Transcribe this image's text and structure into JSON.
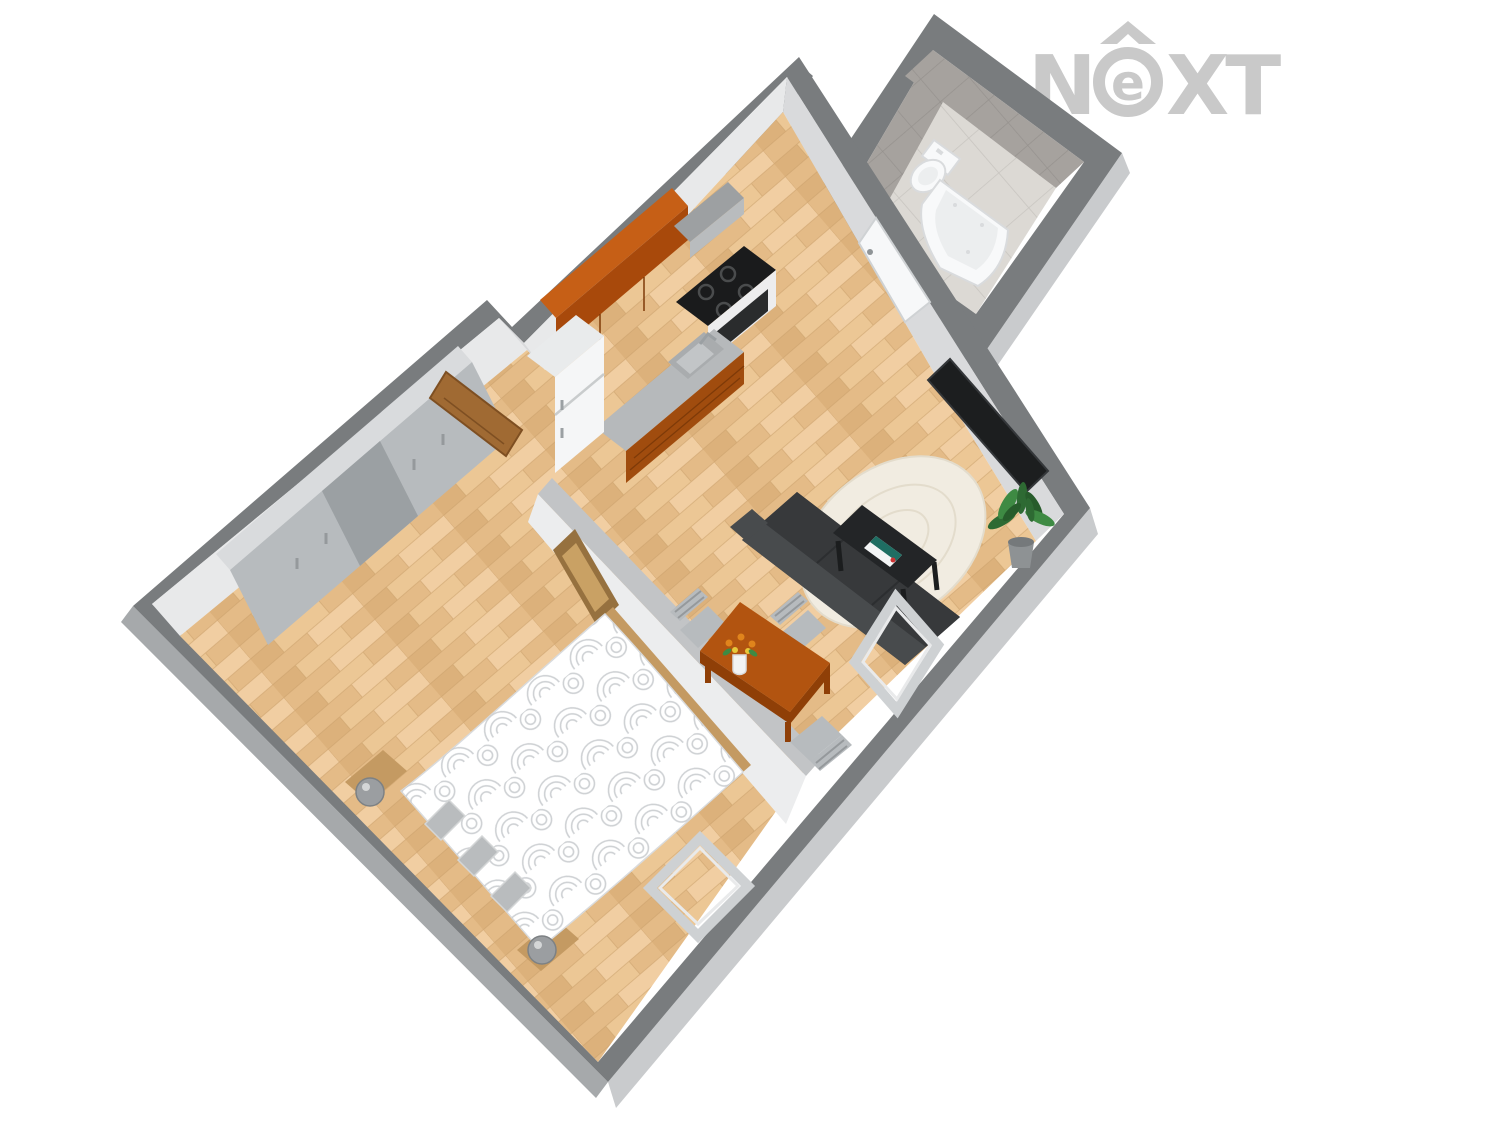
{
  "watermark": {
    "part1": "N",
    "ring_letter": "e",
    "part2": "XT"
  },
  "scene": {
    "type": "3d-floor-plan-render",
    "view": "isometric-cutaway",
    "rooms": [
      {
        "name": "bathroom",
        "floor": "ceramic-tile",
        "walls": "gray-tile",
        "fixtures": [
          "toilet",
          "corner-bathtub"
        ]
      },
      {
        "name": "hallway",
        "floor": "ceramic-tile",
        "fixtures": [
          "white-interior-door"
        ]
      },
      {
        "name": "kitchen-living-room",
        "floor": "wood-parquet",
        "fixtures": [
          "upper-cabinets",
          "range-hood",
          "stove-with-oven",
          "counter-with-sink",
          "refrigerator",
          "wall-tv",
          "sofa",
          "coffee-table",
          "magazine",
          "area-rug",
          "potted-plant",
          "dining-table",
          "flower-vase",
          "dining-chair",
          "dining-chair",
          "dining-chair",
          "leaning-window-frame"
        ]
      },
      {
        "name": "bedroom",
        "floor": "wood-parquet",
        "fixtures": [
          "double-bed",
          "pillow",
          "pillow",
          "pillow",
          "bedside-lamp",
          "bedside-lamp",
          "wardrobe",
          "picture-frame",
          "wood-interior-door",
          "leaning-window-frame"
        ]
      }
    ]
  },
  "colors": {
    "background": "#ffffff",
    "logo": "#c9c9c9",
    "wallTop": "#797c7e",
    "partitionTop": "#c2c4c6",
    "partitionFace": "#ecedee",
    "wallFace": "#d9dadc",
    "wallFaceBright": "#e8e9ea",
    "wallOuterSE": "#c9cbcd",
    "wallOuterSW": "#a6a9ab",
    "tileWallBase": "#a6a29e",
    "tileWallLine": "#96928e",
    "tileFloorBase": "#dcd9d4",
    "tileFloorLine": "#c8c5c0",
    "wood1": "#ecc795",
    "wood2": "#e4bb87",
    "wood3": "#f1cea2",
    "wood4": "#dcb17b",
    "woodLine": "#c9a06b",
    "cabUpper": "#a8490b",
    "cabUpperTop": "#c65f16",
    "cabLower": "#a04c0e",
    "cabLine": "#7e3a08",
    "counter": "#b6b9bb",
    "sinkWell": "#a9acae",
    "sinkInner": "#c2c5c7",
    "hoodFront": "#b9bcbe",
    "hoodTop": "#9da0a2",
    "stoveTop": "#1a1b1c",
    "burnerRing": "#4a4c4d",
    "stoveFront": "#ededee",
    "ovenWindow": "#2a2c2d",
    "fridge": "#f5f6f7",
    "fridgeTop": "#e9ebec",
    "applianceLine": "#c9cccd",
    "applianceHandle": "#9ba0a3",
    "sofaBody": "#3c3f41",
    "sofaBack": "#484b4d",
    "sofaSeat": "#37393b",
    "sofaSeam": "#2c2e30",
    "coffeeTable": "#232527",
    "tableLeg": "#1b1d1e",
    "rug": "#f1ece1",
    "rugLine": "#e3dccc",
    "tv": "#1c1e1f",
    "tvEdge": "#34373a",
    "plantGreen1": "#2e6a33",
    "plantGreen2": "#3e8a43",
    "plantGreen3": "#275c2b",
    "pot": "#8e9294",
    "potRim": "#75797b",
    "dining": "#b25410",
    "diningEdge": "#8f3f07",
    "chair": "#b7bbbe",
    "chairLine": "#95999c",
    "doorWood": "#a06a33",
    "doorWoodEdge": "#7e4f22",
    "doorWhite": "#f7f8f9",
    "doorFrameLine": "#cfd2d4",
    "doorHandle": "#8f9497",
    "frameWood": "#96713f",
    "frameWoodLight": "#c9a164",
    "duvet": "#ffffff",
    "duvetLine": "#c9cccf",
    "pillow": "#b9bcbe",
    "pillowEdge": "#d4d6d7",
    "bedWood": "#c49a62",
    "lamp": "#9b9ea1",
    "lampEdge": "#7d8184",
    "windowFrame": "#ced1d3",
    "windowFrameInner": "#e9eaeb",
    "fixtureWhite": "#f8f9fa",
    "fixtureShadow": "#d9dbdd",
    "fixtureInner": "#eceeef",
    "vase": "#f2f3f4",
    "flowerOrange": "#e0841c",
    "flowerYellow": "#e8c83a",
    "magazineWhite": "#f4f5f6",
    "magazineTeal": "#1f6e63",
    "magazineRed": "#cc3333"
  }
}
